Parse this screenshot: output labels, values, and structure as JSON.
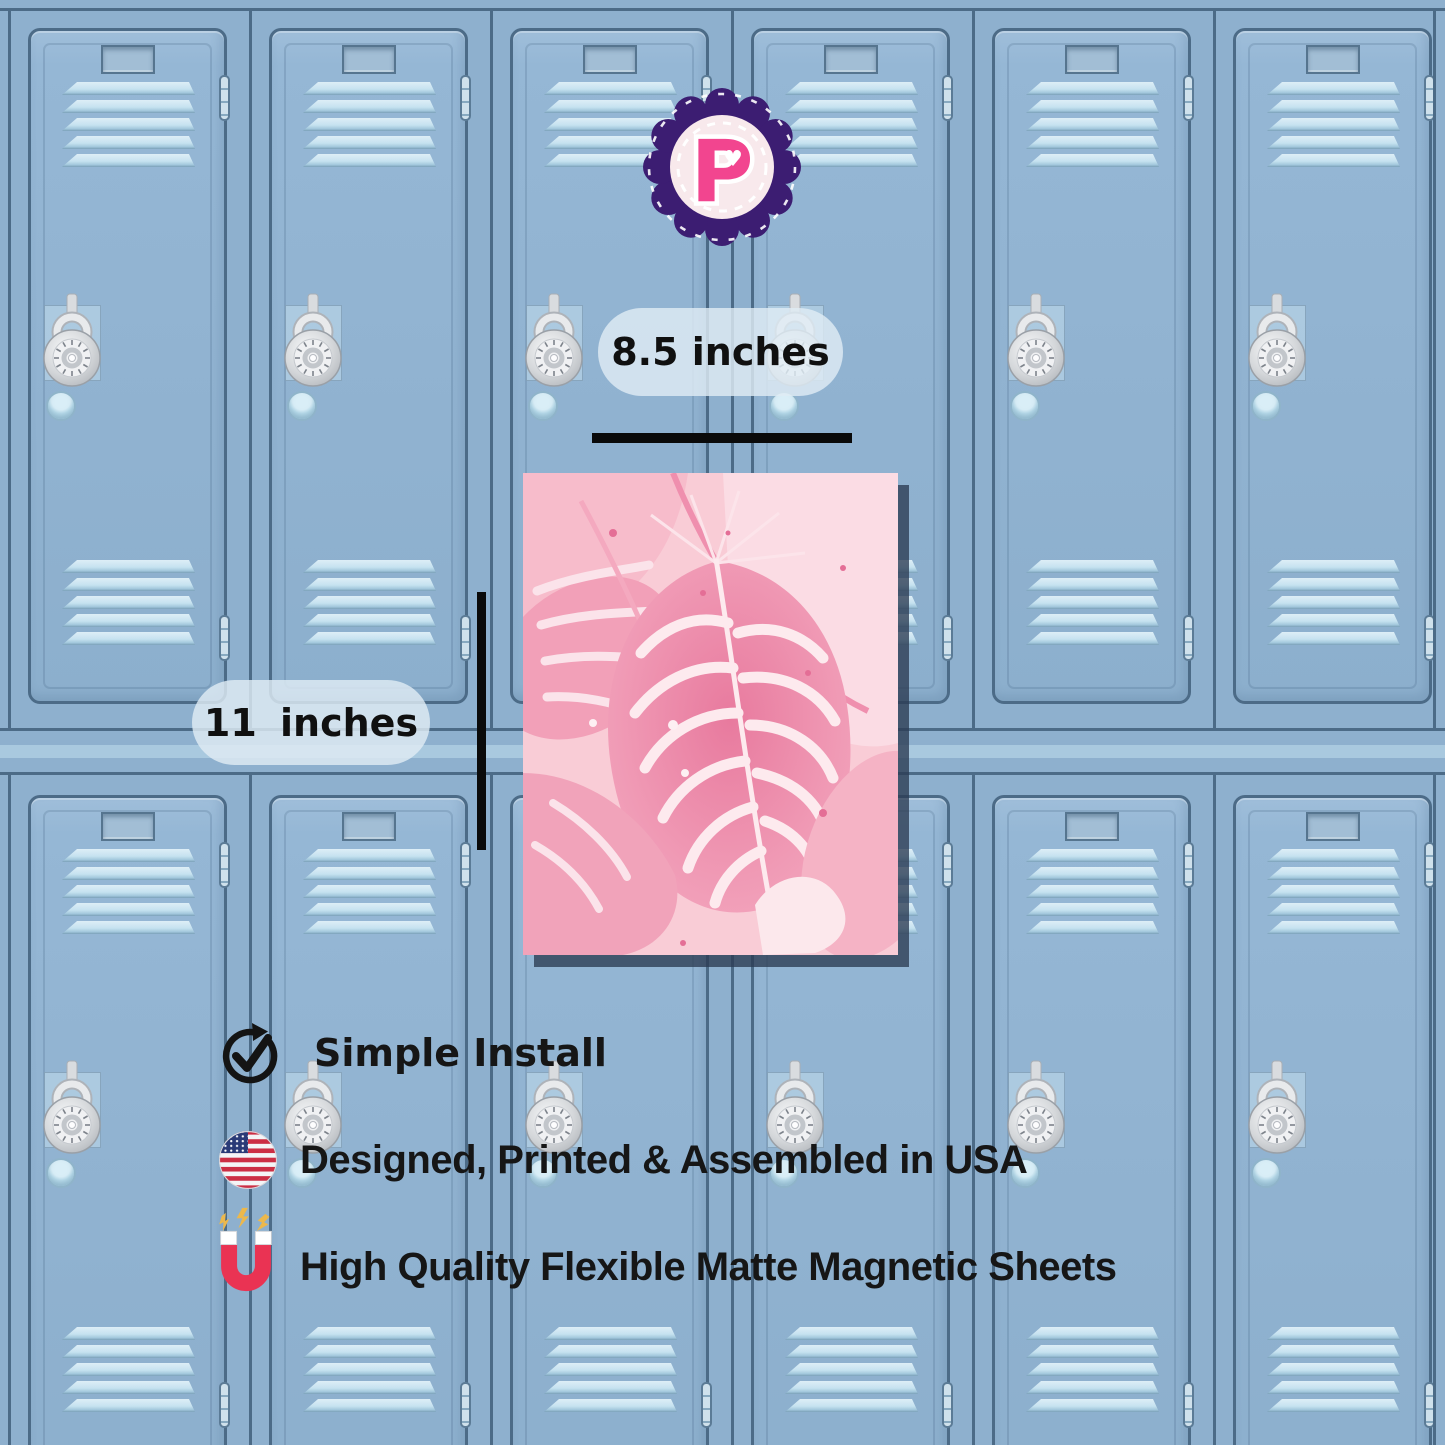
{
  "brand": {
    "letter": "P",
    "heart_glyph": "♥"
  },
  "dimensions": {
    "width_label": "8.5 inches",
    "height_label": "11 inches"
  },
  "poster": {
    "description": "pink watercolor monstera leaves art print"
  },
  "features": [
    {
      "icon": "check-circle-icon",
      "label": "Simple Install"
    },
    {
      "icon": "usa-flag-icon",
      "label": "Designed, Printed & Assembled in USA"
    },
    {
      "icon": "magnet-icon",
      "label": "High Quality Flexible Matte Magnetic Sheets"
    }
  ],
  "scene": {
    "lockers": {
      "rows": 2,
      "columns": 6,
      "elements": [
        "name-plate",
        "vent-slats",
        "combination-lock",
        "round-knob",
        "hinges"
      ]
    }
  },
  "colors": {
    "locker_blue": "#8eb0ce",
    "locker_border": "#4c6b87",
    "vent_light": "#cfe6f2",
    "divider_stripe": "#a9c9df",
    "measure_line": "#0a0a0a",
    "pill_bg": "rgba(223,236,244,0.82)",
    "text": "#161616",
    "poster_pink_bg": "#f9ccd6",
    "poster_pink_deep": "#e87a9e",
    "badge_purple": "#3c1d72",
    "badge_inner": "#f8e9ec",
    "badge_pink": "#f2458f",
    "magnet_red": "#ea3353",
    "flag_red": "#cc2e44",
    "flag_blue": "#2a3a77",
    "spark_yellow": "#ecb84c"
  }
}
